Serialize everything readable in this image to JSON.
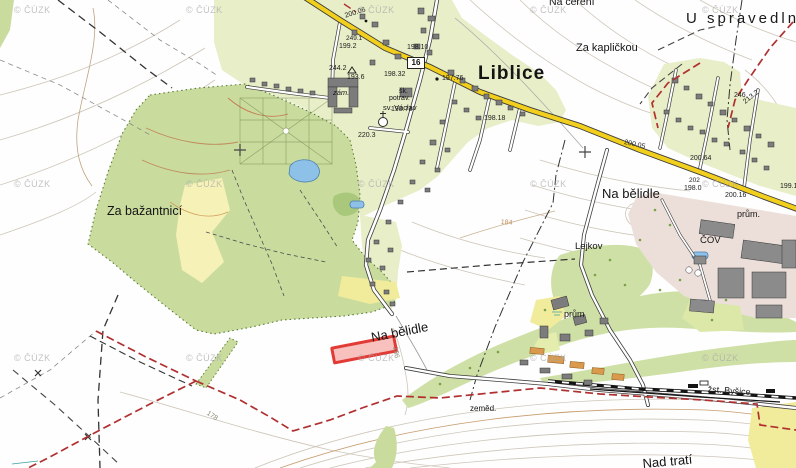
{
  "map": {
    "watermark": "© ČÚZK",
    "labels": {
      "town": "Liblice",
      "za_bazantnici": "Za bažantnicí",
      "na_belidle_upper": "Na bělidle",
      "na_belidle_lower": "Na bělidle",
      "u_spravedlnosti": "U spravedlnosti",
      "na_cereni": "Na čeření",
      "za_kaplickou": "Za kapličkou",
      "lejkov": "Lejkov",
      "cov": "ČOV",
      "prum_upper": "prům.",
      "prum_lower": "prům",
      "zemed": "zeměd.",
      "zst_bysice": "žst. Byšice",
      "nad_trati": "Nad tratí",
      "zamek_abbr": "zám.",
      "skola_abbr": "šk.",
      "potraviny_abbr": "potrav.",
      "sv_vaclav": "sv. Václav",
      "road_number": "16"
    },
    "elevations": [
      "200.06",
      "249.1",
      "199.2",
      "244.2",
      "193.6",
      "198.32",
      "198.10",
      "197.76",
      "198.73",
      "220.3",
      "198.18",
      "200.05",
      "200.64",
      "202",
      "198.0",
      "200.16",
      "199.1",
      "246",
      "213.2"
    ],
    "contour_labels": [
      "186",
      "178",
      "184"
    ],
    "highlight": {
      "color": "#e23b36"
    }
  }
}
